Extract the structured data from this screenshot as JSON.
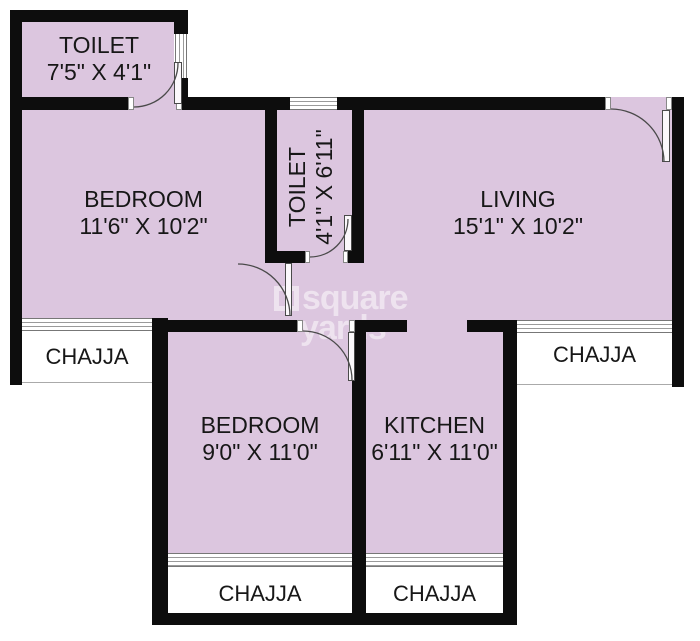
{
  "watermark": {
    "icon": "square-outline",
    "line1": "square",
    "line2": "yards"
  },
  "rooms": {
    "toilet_top": {
      "name": "TOILET",
      "dims": "7'5\" X 4'1\""
    },
    "bedroom_top": {
      "name": "BEDROOM",
      "dims": "11'6\" X 10'2\""
    },
    "toilet_mid": {
      "name": "TOILET",
      "dims": "4'1\" X 6'11\""
    },
    "living": {
      "name": "LIVING",
      "dims": "15'1\" X 10'2\""
    },
    "bedroom_bottom": {
      "name": "BEDROOM",
      "dims": "9'0\" X 11'0\""
    },
    "kitchen": {
      "name": "KITCHEN",
      "dims": "6'11\" X 11'0\""
    }
  },
  "chajjas": {
    "left": "CHAJJA",
    "right": "CHAJJA",
    "bottom_left": "CHAJJA",
    "bottom_right": "CHAJJA"
  },
  "colors": {
    "floor": "#dcc6df",
    "wall": "#0d0d0d"
  }
}
